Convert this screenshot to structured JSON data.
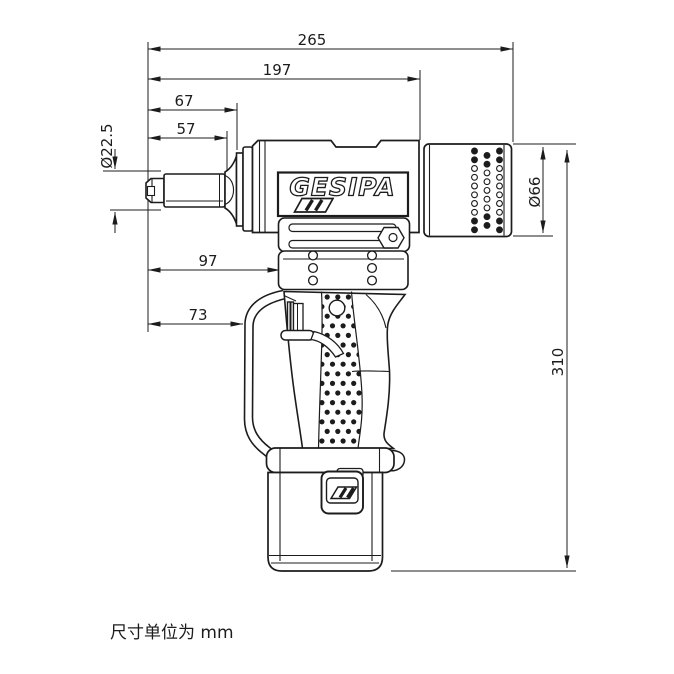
{
  "drawing": {
    "brand_label": "GESIPA",
    "note": "尺寸单位为 mm",
    "dims": {
      "overall_length": "265",
      "upper_body_length": "197",
      "front_section_length": "67",
      "nose_length": "57",
      "nose_diameter": "Ø22.5",
      "nose_to_handle": "97",
      "nose_to_loop": "73",
      "rear_cap_diameter": "Ø66",
      "overall_height": "310"
    }
  }
}
